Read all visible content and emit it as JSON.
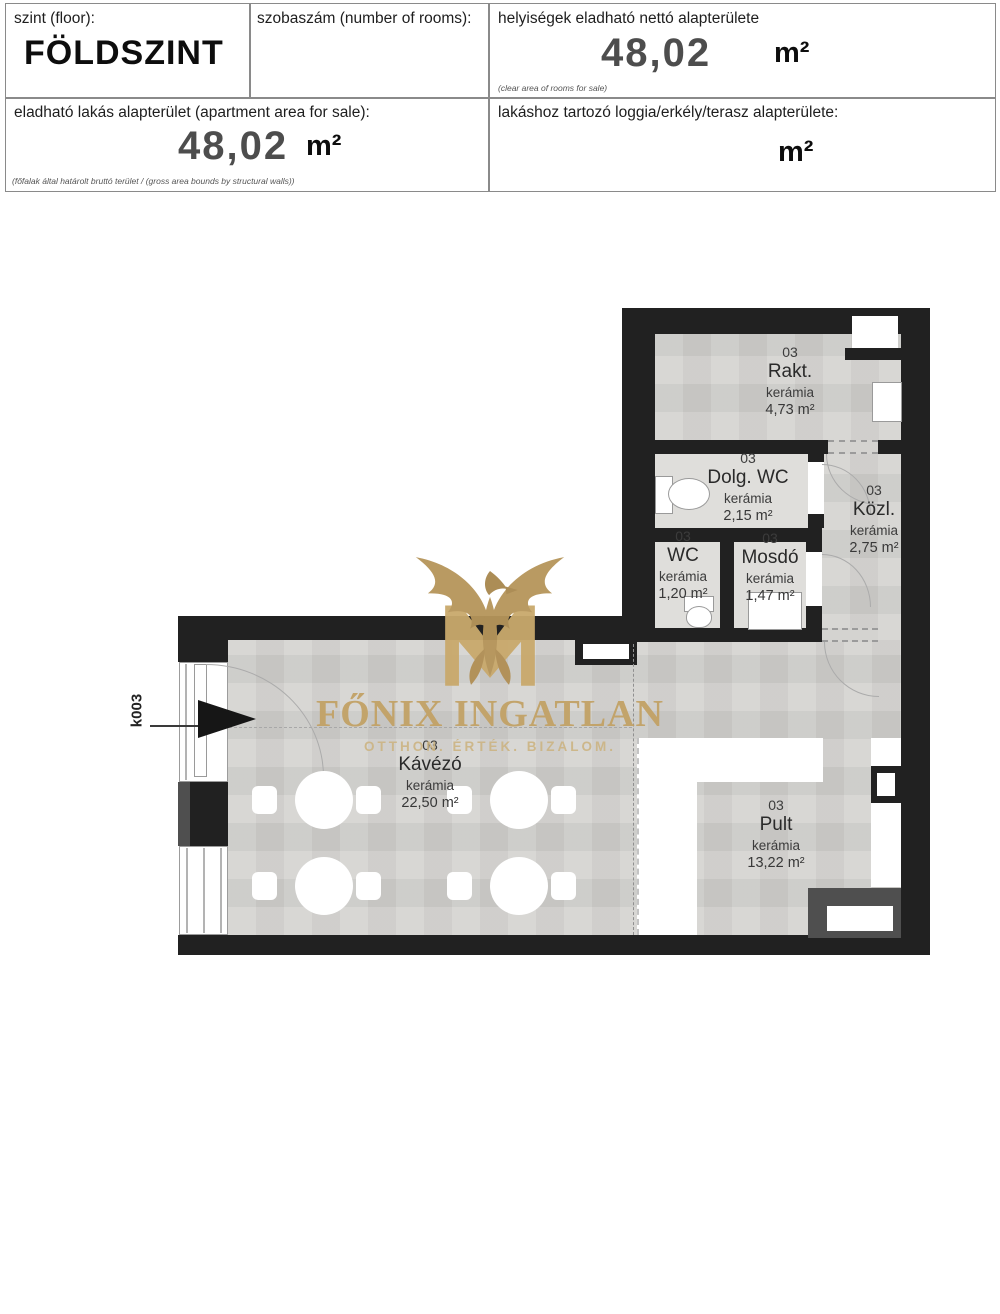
{
  "header": {
    "floor": {
      "label": "szint (floor):",
      "value": "FÖLDSZINT"
    },
    "rooms_count": {
      "label": "szobaszám (number of rooms):"
    },
    "net_area": {
      "label": "helyiségek eladható nettó alapterülete",
      "value": "48,02",
      "unit": "m²",
      "note": "(clear area of rooms for sale)"
    },
    "apartment_area": {
      "label": "eladható lakás alapterület (apartment area for sale):",
      "value": "48,02",
      "unit": "m²",
      "note": "(főfalak által határolt bruttó terület / (gross area bounds by structural walls))"
    },
    "terrace_area": {
      "label": "lakáshoz tartozó loggia/erkély/terasz alapterülete:",
      "unit": "m²"
    }
  },
  "watermark": {
    "brand": "FŐNIX INGATLAN",
    "tagline": "OTTHON. ÉRTÉK. BIZALOM.",
    "gold": "#c2a164"
  },
  "plan": {
    "entrance_code": "k003",
    "colors": {
      "wall": "#212121",
      "floor": "#d4d3d0",
      "room_light": "#dfdedb"
    },
    "rooms": [
      {
        "id": "03",
        "name": "Rakt.",
        "material": "kerámia",
        "area": "4,73 m²"
      },
      {
        "id": "03",
        "name": "Dolg. WC",
        "material": "kerámia",
        "area": "2,15 m²"
      },
      {
        "id": "03",
        "name": "Közl.",
        "material": "kerámia",
        "area": "2,75 m²"
      },
      {
        "id": "03",
        "name": "WC",
        "material": "kerámia",
        "area": "1,20 m²"
      },
      {
        "id": "03",
        "name": "Mosdó",
        "material": "kerámia",
        "area": "1,47 m²"
      },
      {
        "id": "03",
        "name": "Kávézó",
        "material": "kerámia",
        "area": "22,50 m²"
      },
      {
        "id": "03",
        "name": "Pult",
        "material": "kerámia",
        "area": "13,22 m²"
      }
    ]
  }
}
